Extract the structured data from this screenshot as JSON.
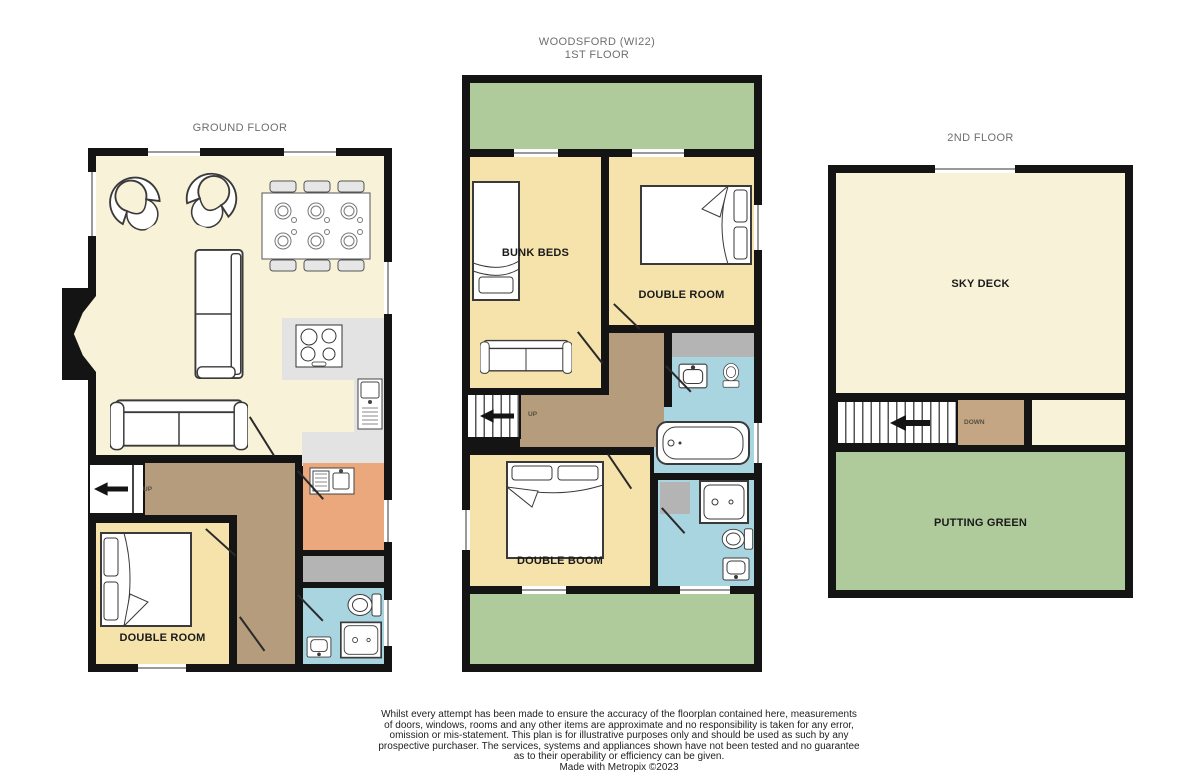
{
  "title": {
    "line1": "WOODSFORD (WI22)",
    "line2": "1ST FLOOR"
  },
  "floors": {
    "ground": {
      "label": "GROUND FLOOR",
      "double_room": "DOUBLE ROOM",
      "stairs_direction": "UP"
    },
    "first": {
      "bunk_beds": "BUNK BEDS",
      "double_room": "DOUBLE ROOM",
      "double_boom": "DOUBLE BOOM",
      "stairs_direction": "UP"
    },
    "second": {
      "label": "2ND FLOOR",
      "sky_deck": "SKY DECK",
      "putting_green": "PUTTING GREEN",
      "stairs_direction": "DOWN"
    }
  },
  "disclaimer": {
    "lines": [
      "Whilst every attempt has been made to ensure the accuracy of the floorplan contained here, measurements",
      "of doors, windows, rooms and any other items are approximate and no responsibility is taken for any error,",
      "omission or mis-statement. This plan is for illustrative purposes only and should be used as such by any",
      "prospective purchaser. The services, systems and appliances shown have not been tested and no guarantee",
      "as to their operability or efficiency can be given.",
      "Made with Metropix ©2023"
    ]
  },
  "colors": {
    "wall": "#141414",
    "cream": "#f8f2d8",
    "yellow": "#f5e3ab",
    "green": "#afca9b",
    "brown": "#b59c7c",
    "landing": "#c4a584",
    "blue": "#a9d5e1",
    "orange": "#eba87d",
    "grey": "#b4b4b4",
    "counter": "#e3e3e3",
    "muted": "#6e6e6e",
    "ink": "#1a1a1a"
  }
}
